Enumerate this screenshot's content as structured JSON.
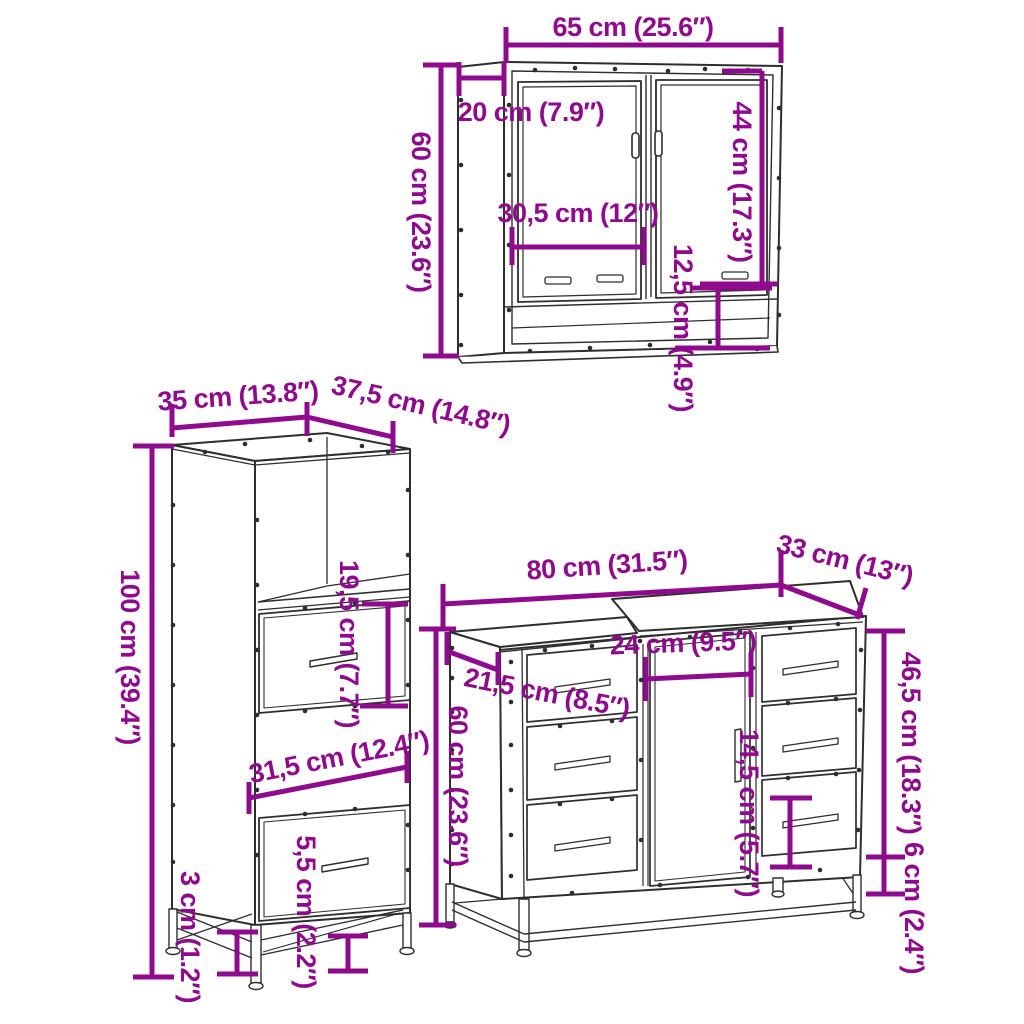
{
  "title": "3 Piece Bathroom Furniture Set Dimension Diagram",
  "colors": {
    "dimension": "#8F0A8C",
    "outline": "#2E2E2E",
    "background": "#FFFFFF"
  },
  "pieces": {
    "mirror_cabinet": {
      "name": "mirror cabinet",
      "dims": {
        "width": "65 cm (25.6″)",
        "depth": "20 cm (7.9″)",
        "height": "60 cm (23.6″)",
        "door_height": "44 cm (17.3″)",
        "inner_width": "30,5 cm (12″)",
        "shelf_height": "12,5 cm (4.9″)"
      }
    },
    "tall_cabinet": {
      "name": "tall side cabinet",
      "dims": {
        "width": "35 cm (13.8″)",
        "depth": "37,5 cm (14.8″)",
        "height": "100 cm (39.4″)",
        "compartment_height": "19,5 cm (7.7″)",
        "inner_width": "31,5 cm (12.4″)",
        "drawer_gap": "5,5 cm (2.2″)",
        "clearance": "3 cm (1.2″)"
      }
    },
    "vanity_cabinet": {
      "name": "sink vanity cabinet",
      "dims": {
        "width": "80 cm (31.5″)",
        "depth": "33 cm (13″)",
        "height": "60 cm (23.6″)",
        "door_width": "24 cm (9.5″)",
        "left_section_width": "21,5 cm (8.5″)",
        "drawer_column_height": "46,5 cm (18.3″)",
        "drawer_height": "14,5 cm (5.7″)",
        "clearance": "6 cm (2.4″)"
      }
    }
  }
}
